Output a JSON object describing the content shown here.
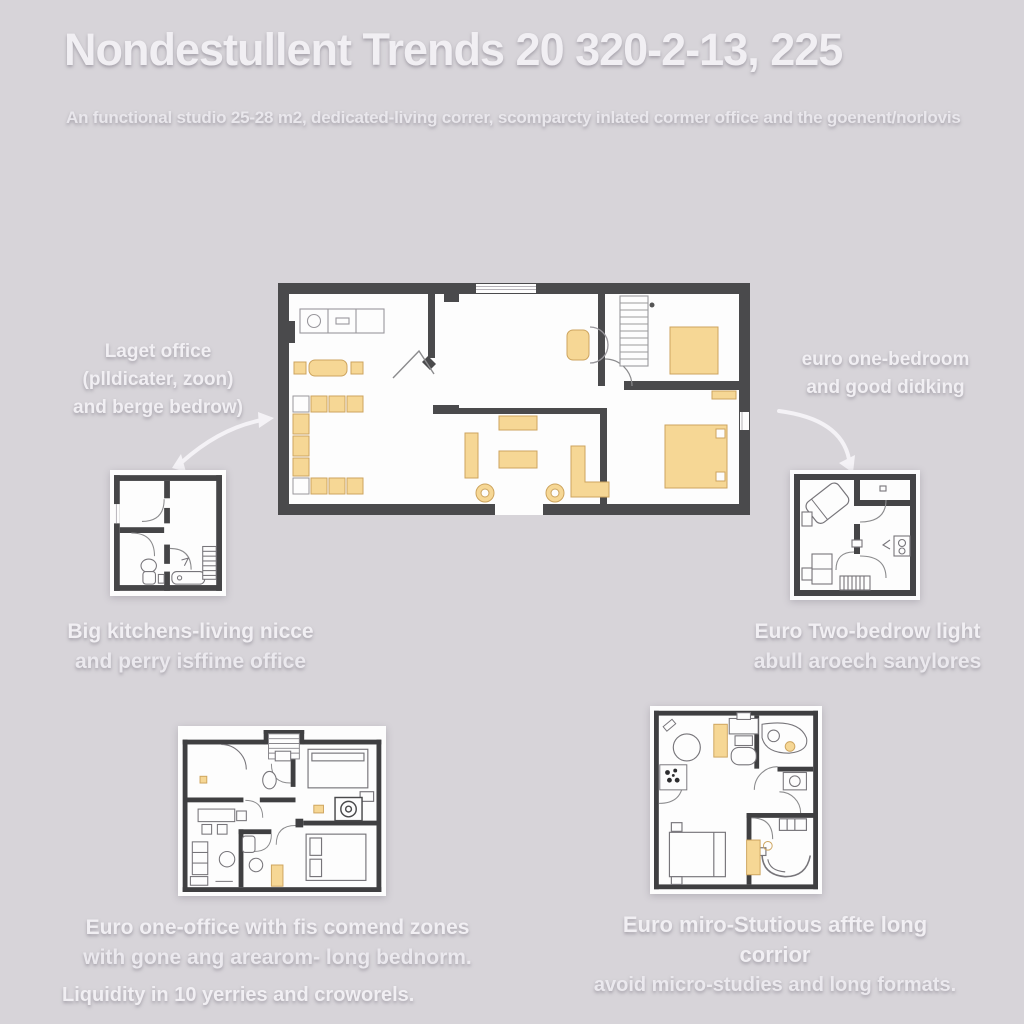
{
  "header": {
    "title": "Nondestullent Trends 20 320-2-13, 225",
    "subtitle": "An functional studio 25-28 m2, dedicated-living correr, scomparcty inlated cormer office and the goenent/norlovis"
  },
  "annotations": {
    "left": {
      "lines": [
        "Laget office",
        "(plldicater, zoon)",
        "and berge bedrow)"
      ]
    },
    "right": {
      "lines": [
        "euro one-bedroom",
        "and good didking"
      ]
    }
  },
  "captions": {
    "left_small": {
      "lines": [
        "Big kitchens-living nicce",
        "and perry isffime office"
      ]
    },
    "right_small": {
      "lines": [
        "Euro Two-bedrow light",
        "abull aroech sanylores"
      ]
    },
    "bottom_left": {
      "lines": [
        "Euro one-office with fis comend zones",
        "with gone ang arearom- long bednorm."
      ]
    },
    "bottom_right": {
      "lines": [
        "Euro miro-Stutious affte long corrior",
        "avoid micro-studies and long formats."
      ]
    }
  },
  "footer": {
    "text": "Liquidity in 10 yerries and croworels."
  },
  "colors": {
    "background": "#d7d4d9",
    "wall_dark": "#4a4a4c",
    "plan_interior": "#fdfdfd",
    "furniture_tan": "#f6d795",
    "furniture_tan_border": "#cda45e",
    "text_white": "#f1eff3"
  }
}
